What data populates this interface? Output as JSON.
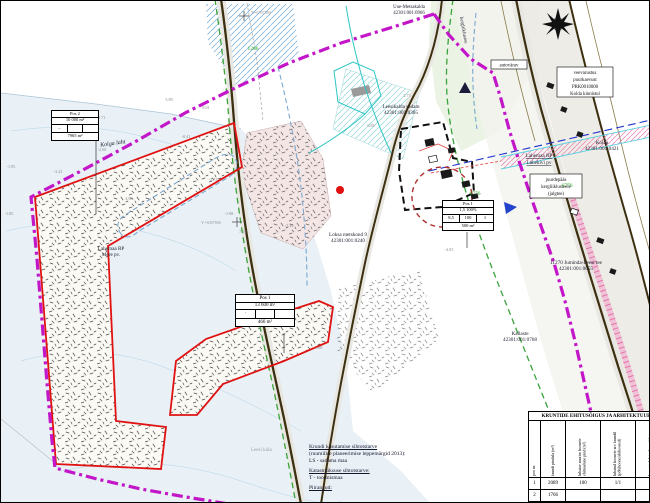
{
  "map": {
    "parcel_labels": [
      {
        "line1": "Uue-Metsakalda",
        "line2": "42301:001:0966"
      },
      {
        "line1": "Leesikalda sadam",
        "line2": "42301:001:0365"
      },
      {
        "line1": "Loksa metskond 9",
        "line2": "42301:001:0240"
      },
      {
        "line1": "Kolda",
        "line2": "42301:001:0421"
      },
      {
        "line1": "11270 Juminda-Leesi tee",
        "line2": "42301:001:0055"
      },
      {
        "line1": "Lahemaa RP",
        "line2": "Mere pv."
      },
      {
        "line1": "Kallaste",
        "line2": "42301:001:0768"
      },
      {
        "line1": "Kolga laht",
        "line2": ""
      }
    ],
    "protected_area_label": {
      "line1": "Lahemaa RP",
      "line2": "Lahekivi pv"
    },
    "boxed_labels": {
      "gate": "autovärav",
      "water1": "veevarustus",
      "water2": "puurkaevust",
      "water3": "PRK0010000",
      "water4": "Kolda kinnistul",
      "access1": "juurdepääs",
      "access2": "kergliiklusteele",
      "access3": "(jalgtee)"
    },
    "road_label": "kergliiklustee",
    "green_numbers": [
      {
        "v": "1286"
      },
      {
        "v": "6776"
      },
      {
        "v": "6776"
      }
    ],
    "coordinate_labels": [
      {
        "v": "X=6597800"
      },
      {
        "v": "Y=3007800"
      },
      {
        "v": "7.20"
      }
    ],
    "spot_elevations": [
      {
        "v": "-2.71"
      },
      {
        "v": "-2.60"
      },
      {
        "v": "-3.22"
      },
      {
        "v": "-1.95"
      },
      {
        "v": "-1.85"
      },
      {
        "v": "5.89"
      },
      {
        "v": "8.01"
      },
      {
        "v": "4.09"
      },
      {
        "v": "-2.73"
      },
      {
        "v": "-1.98"
      },
      {
        "v": "-2.38"
      },
      {
        "v": "-0.41"
      },
      {
        "v": "6.85"
      },
      {
        "v": "-4.03"
      },
      {
        "v": "-1.06"
      },
      {
        "v": "2.73"
      }
    ]
  },
  "mini_tables": {
    "pos2": {
      "r1": "Pos 2",
      "r2": "10 000 m²",
      "c1": "–",
      "c2": "",
      "c3": "",
      "r4": "7965 m²"
    },
    "pos1a": {
      "r1": "Pos 1",
      "r2": "13 600 m²",
      "c1": "·",
      "c2": "",
      "c3": "",
      "r4": "466 m²"
    },
    "pos1b": {
      "r1": "Pos 1",
      "r2": "1,5 100%",
      "c1": "8,5",
      "c2": "100",
      "c3": "1",
      "r4": "500 m²"
    }
  },
  "ehitusoigus_table": {
    "title": "KRUNTIDE EHITUSÕIGUS JA ARHITEKTUURINÕUDED",
    "col_headers": [
      "pos nr.",
      "krundi pindala (m²)",
      "lubatav suurim hoonete ehitusalune pind (m²)",
      "lubatud hoonete arv krundil (põhihoone/abihooned)",
      "hoonete lubatud max kõrgus maapinnast (m)"
    ],
    "rows": [
      [
        "1",
        "2089",
        "100",
        "1/1",
        "5.5"
      ],
      [
        "2",
        "1766",
        "",
        "",
        ""
      ]
    ]
  },
  "legend": {
    "village": "Leesi küla",
    "h1": "Krundi kasutamise sihtotstarve",
    "s1": "(ruumilise planeerimise leppemärgid 2013):",
    "i1": "LS - sadama maa",
    "h2": "Katastriüksuse sihtotstarve:",
    "i2": "T - tootmismaa",
    "h3": "Piirangud:"
  },
  "colors": {
    "planning_boundary": "#c216c8",
    "plot_line": "#e01212",
    "green_zone": "#3aa33a",
    "road": "#3c3010",
    "water_line": "#7aa8d0",
    "utility": "#2233cc"
  }
}
